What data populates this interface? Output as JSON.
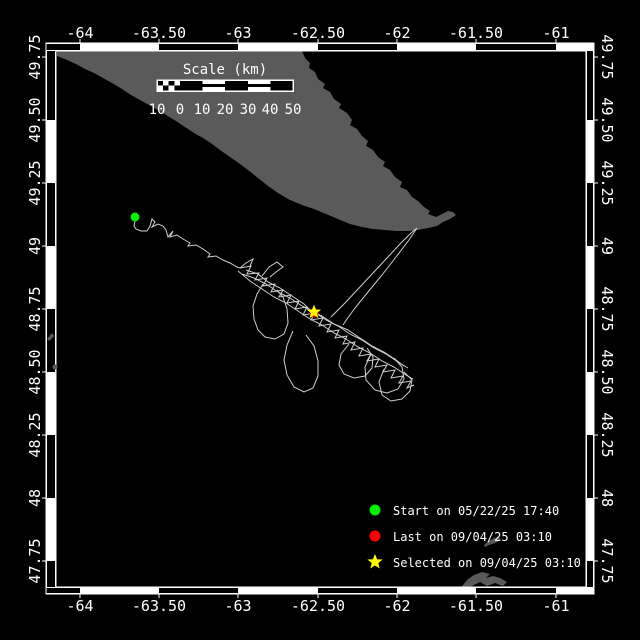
{
  "colors": {
    "background": "#000000",
    "land": "#5a5a5a",
    "track": "#cfcfcf",
    "frame": "#ffffff",
    "text": "#ffffff",
    "start_marker": "#00ee00",
    "last_marker": "#ff0000",
    "selected_marker": "#ffff00"
  },
  "frame": {
    "outer": [
      46,
      43,
      594,
      594
    ],
    "inner": [
      56,
      51,
      586,
      587
    ],
    "clip": [
      57,
      51,
      528,
      536
    ],
    "lon_black_segments": [
      [
        46,
        80
      ],
      [
        159,
        238
      ],
      [
        318,
        397
      ],
      [
        476,
        556
      ]
    ],
    "lat_black_segments": [
      [
        51,
        120
      ],
      [
        183,
        246
      ],
      [
        309,
        372
      ],
      [
        435,
        498
      ],
      [
        561,
        587
      ]
    ]
  },
  "axes": {
    "lon_ticks": [
      {
        "label": "-64",
        "x": 80
      },
      {
        "label": "-63.50",
        "x": 159
      },
      {
        "label": "-63",
        "x": 238
      },
      {
        "label": "-62.50",
        "x": 318
      },
      {
        "label": "-62",
        "x": 397
      },
      {
        "label": "-61.50",
        "x": 476
      },
      {
        "label": "-61",
        "x": 556
      }
    ],
    "lat_ticks": [
      {
        "label": "49.75",
        "y": 57
      },
      {
        "label": "49.50",
        "y": 120
      },
      {
        "label": "49.25",
        "y": 183
      },
      {
        "label": "49",
        "y": 246
      },
      {
        "label": "48.75",
        "y": 309
      },
      {
        "label": "48.50",
        "y": 372
      },
      {
        "label": "48.25",
        "y": 435
      },
      {
        "label": "48",
        "y": 498
      },
      {
        "label": "47.75",
        "y": 561
      }
    ]
  },
  "scale_bar": {
    "title": "Scale (km)",
    "title_x": 225,
    "title_y": 74,
    "x": 157,
    "y": 80,
    "width": 136,
    "height": 11,
    "label_y": 114,
    "labels": [
      {
        "text": "10",
        "x": 157
      },
      {
        "text": "0",
        "x": 180
      },
      {
        "text": "10",
        "x": 202
      },
      {
        "text": "20",
        "x": 225
      },
      {
        "text": "30",
        "x": 248
      },
      {
        "text": "40",
        "x": 270
      },
      {
        "text": "50",
        "x": 293
      }
    ]
  },
  "land": {
    "polygons": [
      "57,51 302,51 305,58 310,63 309,68 315,72 318,79 325,84 323,88 330,92 334,99 341,104 339,108 347,113 352,120 350,125 357,129 362,136 368,141 366,146 373,150 378,157 385,162 383,166 390,170 395,177 402,182 400,187 407,190 412,197 418,201 424,207 430,211 428,214 436,217 442,214 448,211 453,212 456,215 450,219 443,222 437,226 428,228 418,230 408,231 396,231 385,230 373,229 362,227 350,224 338,219 326,214 314,209 302,205 290,200 278,193 268,186 258,178 248,170 240,164 230,157 220,150 212,144 203,138 194,133 185,127 176,121 166,115 158,110 149,105 140,100 131,95 122,89 112,83 103,78 94,73 85,69 76,64 67,60 57,56",
      "463,585 468,579 474,575 482,572 490,574 486,578 493,576 500,578 507,582 503,586 495,583 487,586 480,582 472,586 466,588 460,588",
      "484,545 489,541 494,538 499,537 501,540 495,543 489,545 485,547"
    ],
    "slivers": [
      "47,339 52,333 54,336 49,341"
    ],
    "dots": [
      [
        55,
        367,
        2.5
      ]
    ]
  },
  "track": {
    "lines": [
      "135,221 134,226 136,229 141,231 147,231 150,226 152,219 155,222 152,227 158,224 163,226 166,230 168,237 173,231 170,237 177,235 183,239 190,243 188,246 196,245 203,249 210,254 208,257 216,256 223,260 230,263 237,267 240,268",
      "331,317 345,303 359,288 373,273 387,258 400,244 411,233 417,228 409,240 396,257 382,275 368,292 355,308 347,319 343,325",
      "240,268 251,266 247,274 259,273 255,280 267,278 263,286 275,284 271,292 283,290 279,297 291,295 287,303 299,301 295,309 307,307 303,315 315,313 311,320 323,318 319,326 331,324 327,332 339,330 335,338 347,336 343,344 355,342 351,350 363,348 359,356 371,354 367,361 379,359 375,367 387,365 383,372 395,370 391,378 403,376 399,383 411,381 407,388 414,385",
      "242,274 254,278 266,284 278,292 290,298 302,306 314,312 326,320 338,326 350,334 362,340 374,348 386,354 398,362 408,368",
      "238,271 250,281 262,289 274,297 286,303 298,311 310,319 322,325 334,333 346,339 358,347 370,353 382,361 394,367 406,375 413,379",
      "263,284 257,294 253,306 254,319 258,330 265,337 275,339 284,334 288,323 287,309 283,297 277,290",
      "293,331 287,345 284,360 287,375 294,387 304,392 313,388 318,376 318,361 314,346 306,335",
      "349,344 341,354 339,365 344,374 354,378 365,376 372,368 373,357 367,348",
      "371,354 365,367 366,380 375,390 387,393 398,389 404,379 402,367 394,358",
      "384,369 379,382 382,395 391,401 402,399 410,391 412,380 404,372",
      "262,276 269,267 277,262 283,267 276,272 270,277",
      "246,270 258,274 268,282 280,288 292,296 304,304 310,310 322,316 334,324 348,330 360,338 372,346 384,352 396,360 404,366",
      "240,268 246,263 253,259 250,266"
    ]
  },
  "markers": {
    "start": {
      "x": 135,
      "y": 217,
      "r": 4.5
    },
    "last": {
      "x": 314,
      "y": 313,
      "r": 4.5
    },
    "selected": {
      "x": 314,
      "y": 312,
      "ro": 7.5,
      "ri": 3.2
    }
  },
  "legend": {
    "items": [
      {
        "shape": "circle",
        "color": "#00ee00",
        "label": "Start on 05/22/25 17:40",
        "marker_x": 375,
        "y": 510,
        "text_x": 393
      },
      {
        "shape": "circle",
        "color": "#ff0000",
        "label": "Last on 09/04/25 03:10",
        "marker_x": 375,
        "y": 536,
        "text_x": 393
      },
      {
        "shape": "star",
        "color": "#ffff00",
        "label": "Selected on 09/04/25 03:10",
        "marker_x": 375,
        "y": 562,
        "text_x": 393
      }
    ]
  }
}
